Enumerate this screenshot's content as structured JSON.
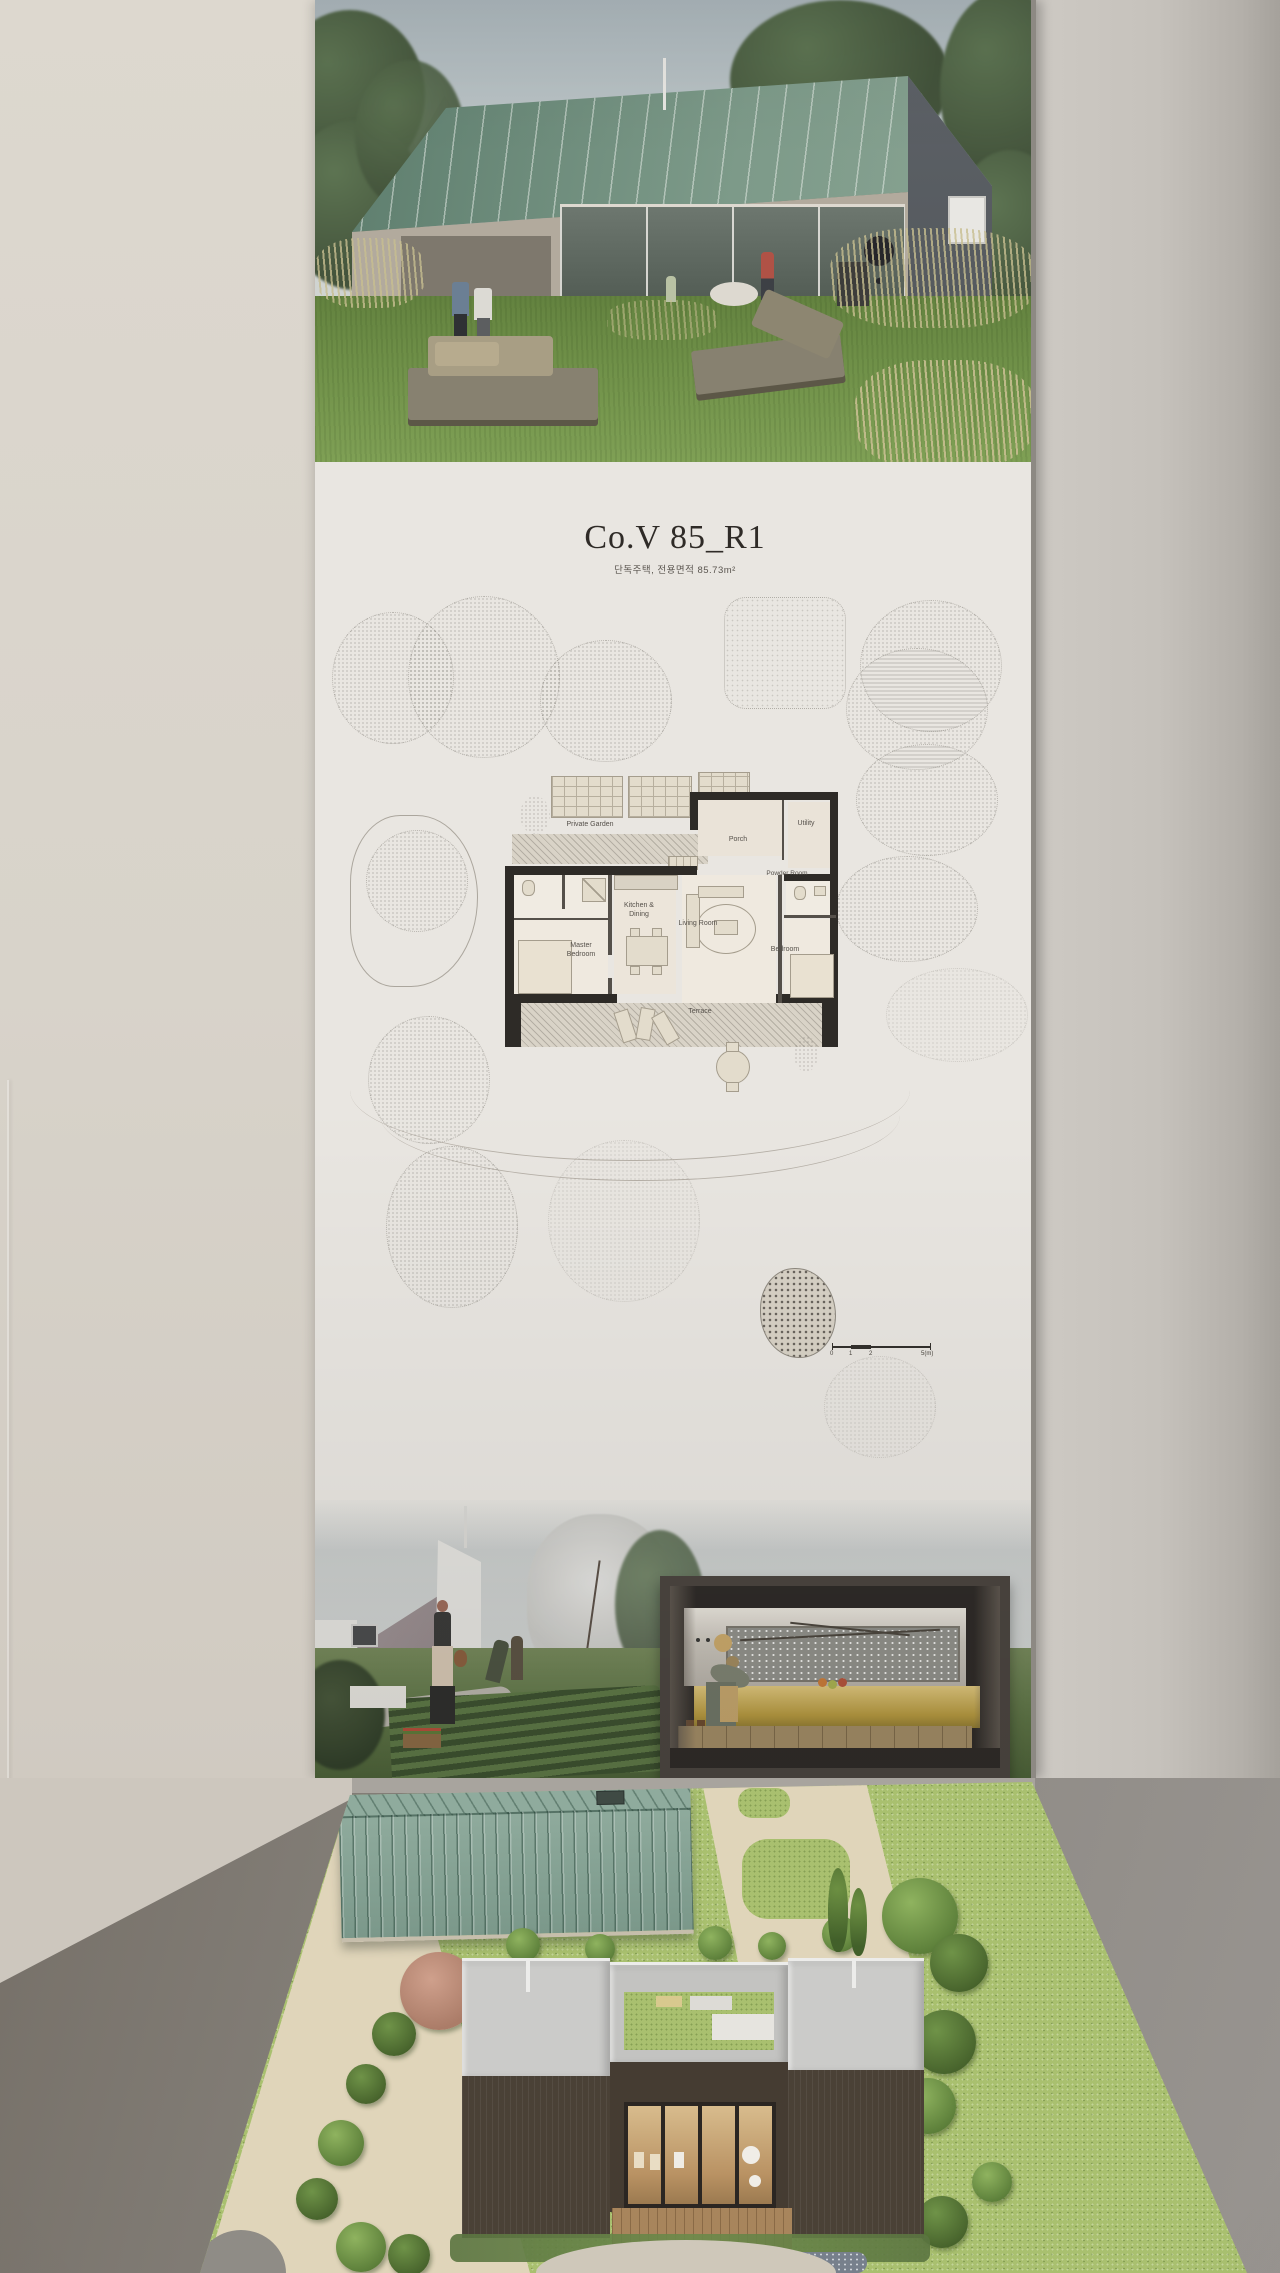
{
  "scene": {
    "description": "Gallery wall with architectural presentation poster and physical scale model on a table"
  },
  "poster": {
    "title": "Co.V 85_R1",
    "subtitle": "단독주택, 전용면적 85.73m²",
    "plan": {
      "private_garden": "Private Garden",
      "porch": "Porch",
      "utility": "Utility",
      "kitchen_dining": "Kitchen & Dining",
      "powder_room": "Powder Room",
      "master_bedroom": "Master Bedroom",
      "living_room": "Living Room",
      "bedroom": "Bedroom",
      "terrace": "Terrace"
    },
    "scale_bar": {
      "labels": [
        "0",
        "1",
        "2",
        "5(m)"
      ]
    }
  },
  "colors": {
    "poster_paper": "#e9e6e1",
    "rendering_roof_green": "#6f8e7d",
    "model_roof_green": "#8aa79a",
    "model_grass": "#a9c06f",
    "left_wall": "#d9d3ca",
    "right_wall": "#c6c2bc",
    "table_grey": "#85827d",
    "plan_wall_black": "#2e2b27"
  }
}
